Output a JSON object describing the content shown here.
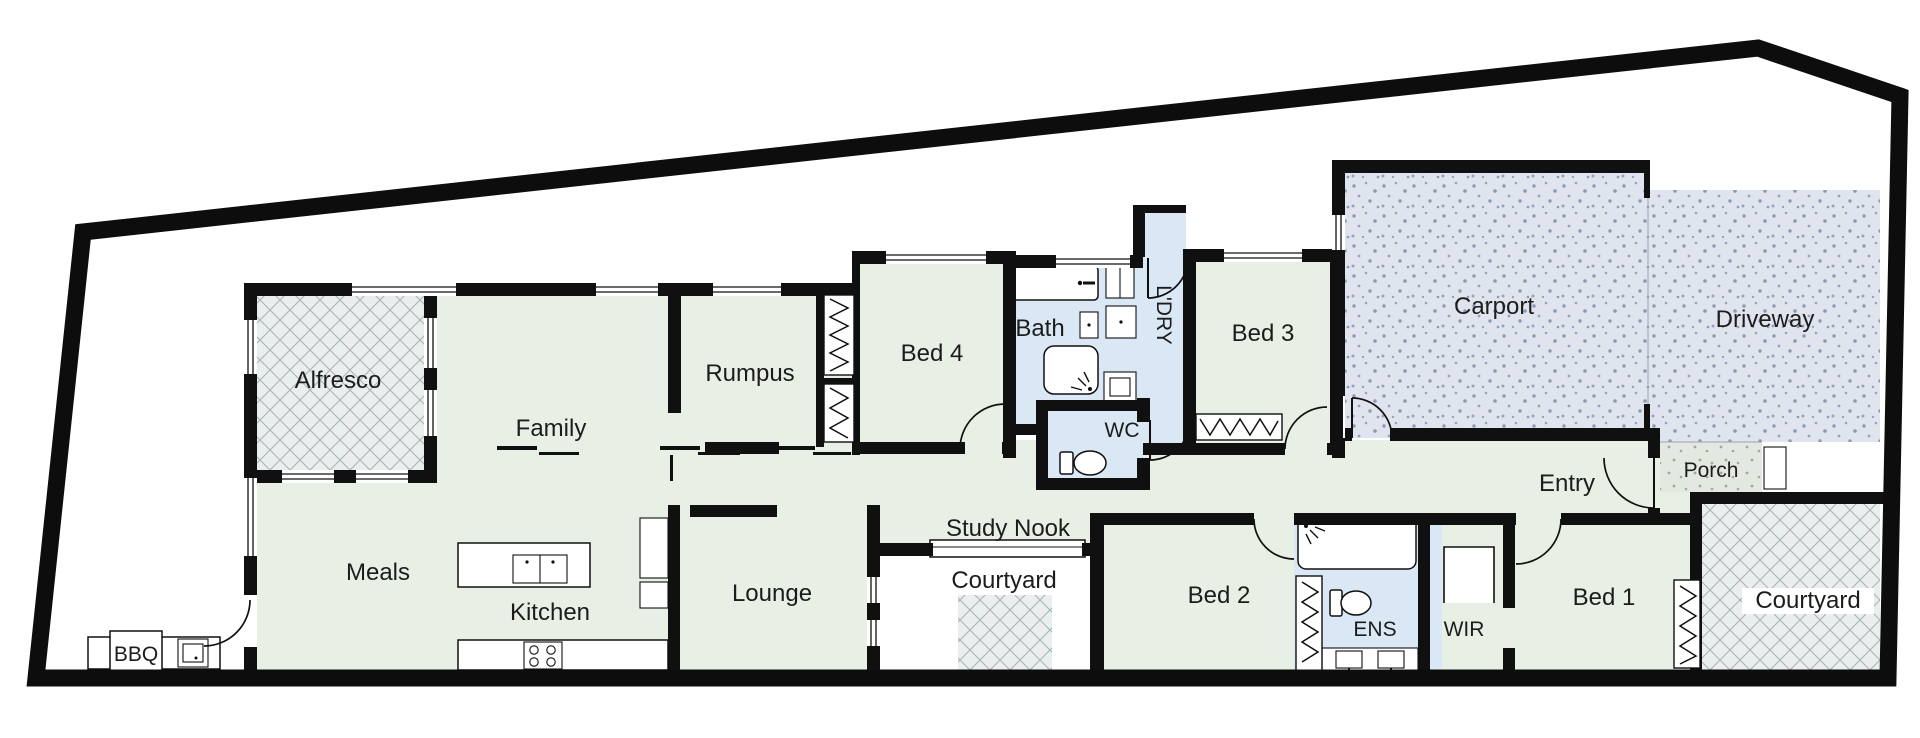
{
  "plan_labels": {
    "alfresco": "Alfresco",
    "family": "Family",
    "rumpus": "Rumpus",
    "bed4": "Bed 4",
    "bath": "Bath",
    "laundry": "L'DRY",
    "wc": "WC",
    "bed3": "Bed 3",
    "carport": "Carport",
    "driveway": "Driveway",
    "entry": "Entry",
    "porch": "Porch",
    "meals": "Meals",
    "kitchen": "Kitchen",
    "lounge": "Lounge",
    "study_nook": "Study Nook",
    "courtyard_center": "Courtyard",
    "bed2": "Bed 2",
    "ensuite": "ENS",
    "wir": "WIR",
    "bed1": "Bed 1",
    "courtyard_right": "Courtyard",
    "bbq": "BBQ"
  },
  "colors": {
    "background": "#ffffff",
    "interior_green": "#e8efe4",
    "wet_area_blue": "#d9e8f4",
    "paving_base": "#ebeeee",
    "paving_line": "#a9b4b4",
    "concrete_base": "#dfe4ef",
    "concrete_dot": "#8e9ab0",
    "porch_base": "#e3e9e0",
    "wall_black": "#101010",
    "label_text": "#1c1c1c"
  }
}
